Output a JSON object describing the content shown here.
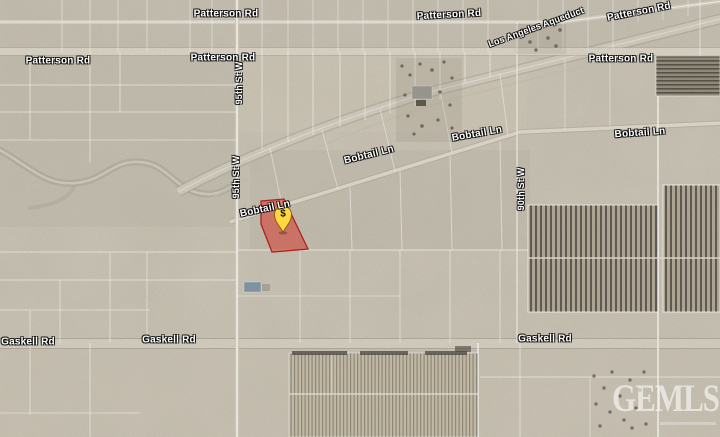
{
  "map": {
    "roads": {
      "patterson": "Patterson Rd",
      "gaskell": "Gaskell Rd",
      "bobtail": "Bobtail Ln",
      "st95": "95th St W",
      "st90": "90th St W",
      "aqueduct": "Los Angeles Aqueduct"
    },
    "marker": {
      "symbol": "$"
    },
    "watermark": {
      "text": "GEMLS"
    },
    "colors": {
      "desert_base": "#c7c0b1",
      "grid_line": "#ffffff",
      "parcel_highlight_fill": "#d63a2e",
      "parcel_highlight_stroke": "#a8251c",
      "pin_fill": "#ffd843",
      "pin_symbol": "#1d1205",
      "label_text": "#ffffff",
      "solar_panel_dark": "#57514a",
      "watermark_color": "#ffffff"
    }
  }
}
